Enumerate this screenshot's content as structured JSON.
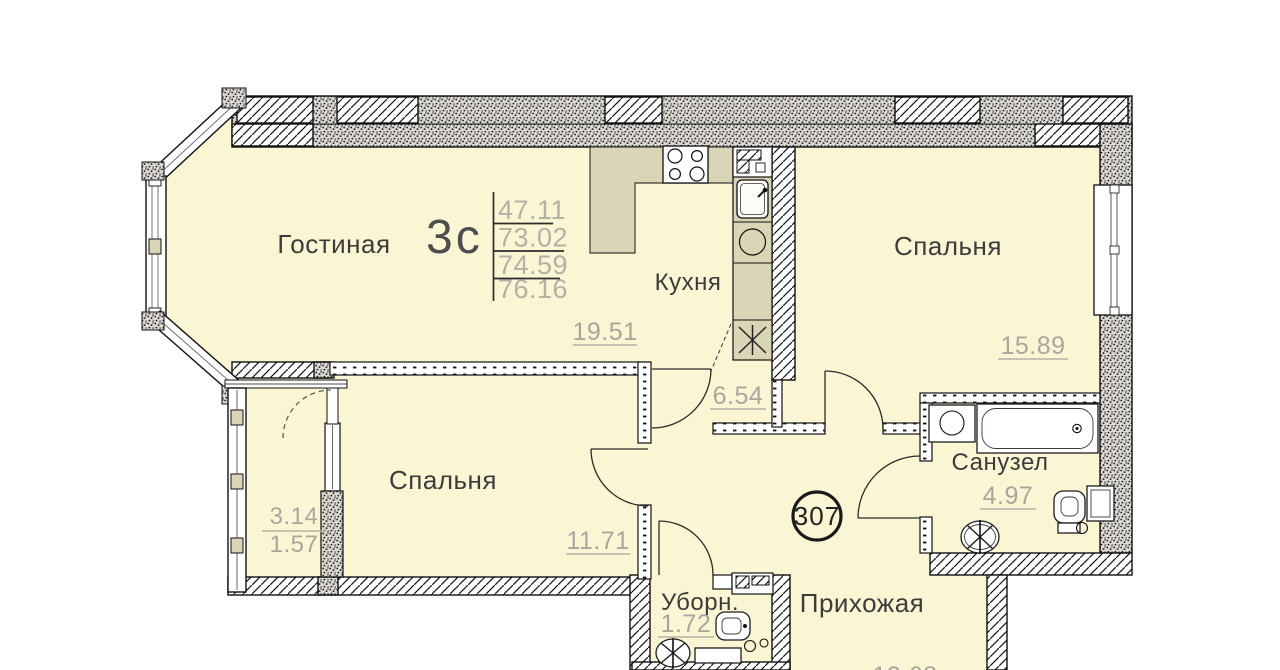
{
  "title": "План квартиры",
  "unit": {
    "badge": "307"
  },
  "legend": {
    "type_label": "3с",
    "rows": [
      "47.11",
      "73.02",
      "74.59",
      "76.16"
    ]
  },
  "rooms": {
    "living": {
      "label": "Гостиная",
      "area": "19.51"
    },
    "kitchen": {
      "label": "Кухня",
      "area": "6.54"
    },
    "bedroom_right": {
      "label": "Спальня",
      "area": "15.89"
    },
    "bedroom_left": {
      "label": "Спальня",
      "area": "11.71"
    },
    "bathroom": {
      "label": "Санузел",
      "area": "4.97"
    },
    "wc": {
      "label": "Уборн.",
      "area": "1.72"
    },
    "hallway": {
      "label": "Прихожая",
      "area": "12.68"
    },
    "balcony": {
      "area_full": "3.14",
      "area_reduced": "1.57"
    }
  },
  "icons": [
    "stove-icon",
    "kitchen-sink-icon",
    "washing-machine-icon",
    "bathtub-icon",
    "toilet-icon",
    "wash-basin-icon",
    "star-vent-icon"
  ],
  "colors": {
    "room_fill": "#FAF6D4",
    "counter_fill": "#D9D5B6",
    "wall_dark": "#1d1d1d",
    "area_text": "#A9A69E",
    "label_text": "#3C3C3C"
  }
}
